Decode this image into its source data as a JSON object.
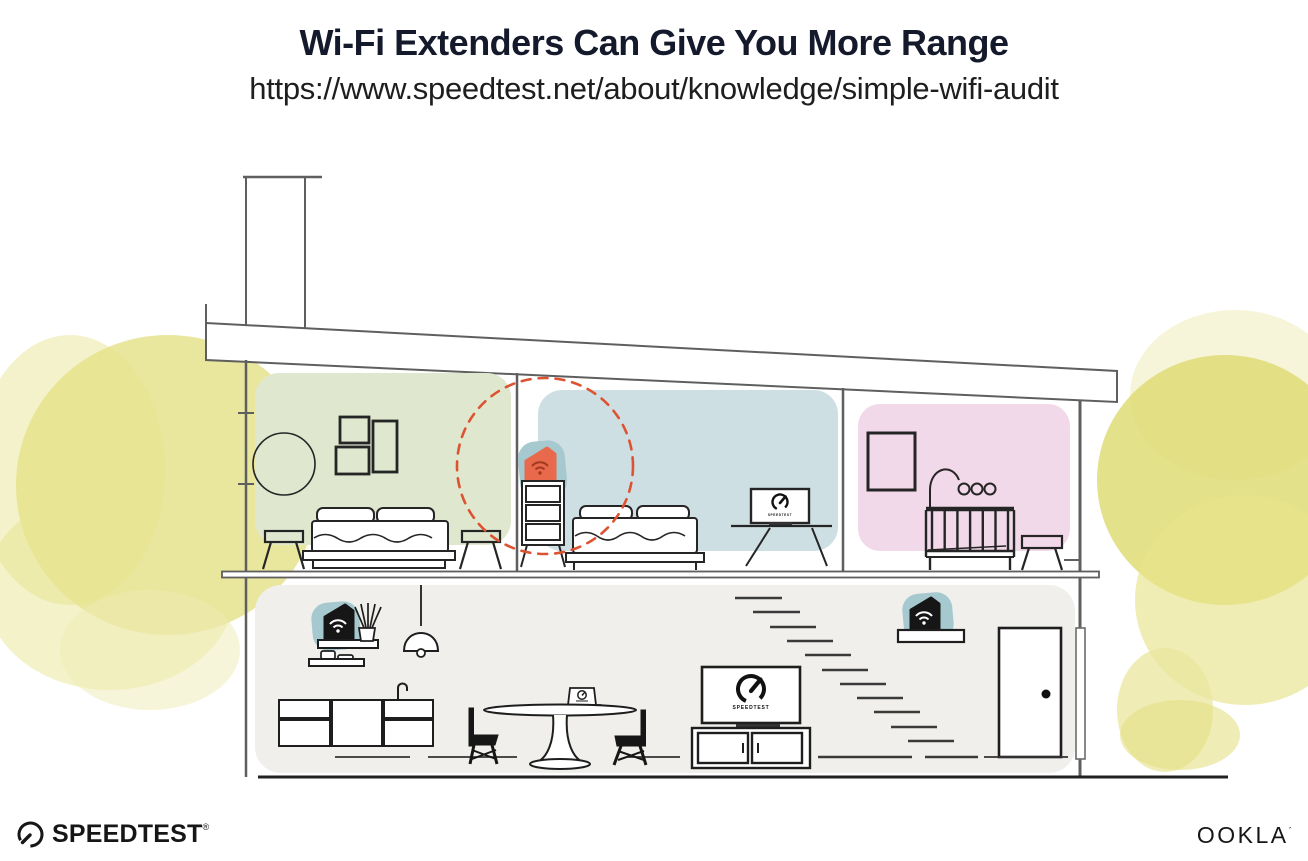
{
  "header": {
    "title": "Wi-Fi Extenders Can Give You More Range",
    "url": "https://www.speedtest.net/about/knowledge/simple-wifi-audit"
  },
  "devices": {
    "bedroom_tv_label": "SPEEDTEST",
    "living_tv_label": "SPEEDTEST"
  },
  "footer": {
    "speedtest_wordmark": "SPEEDTEST",
    "speedtest_reg_mark": "®",
    "ookla_wordmark": "OOKLA",
    "ookla_trade_mark": "´"
  },
  "colors": {
    "title_ink": "#141a2b",
    "structure_line_gray": "#5f5f5f",
    "furniture_ink": "#1e1e1e",
    "room_green": "#dfe8cf",
    "room_blue": "#cedfe3",
    "room_pink": "#f2d9e9",
    "lower_floor_gray": "#f0efeb",
    "device_teal": "#a5c9cf",
    "extender_orange": "#e8694b",
    "extender_wifi_dark": "#a23a20",
    "range_circle_red": "#dd5331",
    "foliage_yellow": "#e2df7e"
  },
  "icons": {
    "wifi_extender": "pentagon-with-wifi-arcs",
    "speedtest_gauge": "speedometer-arc-with-needle"
  }
}
